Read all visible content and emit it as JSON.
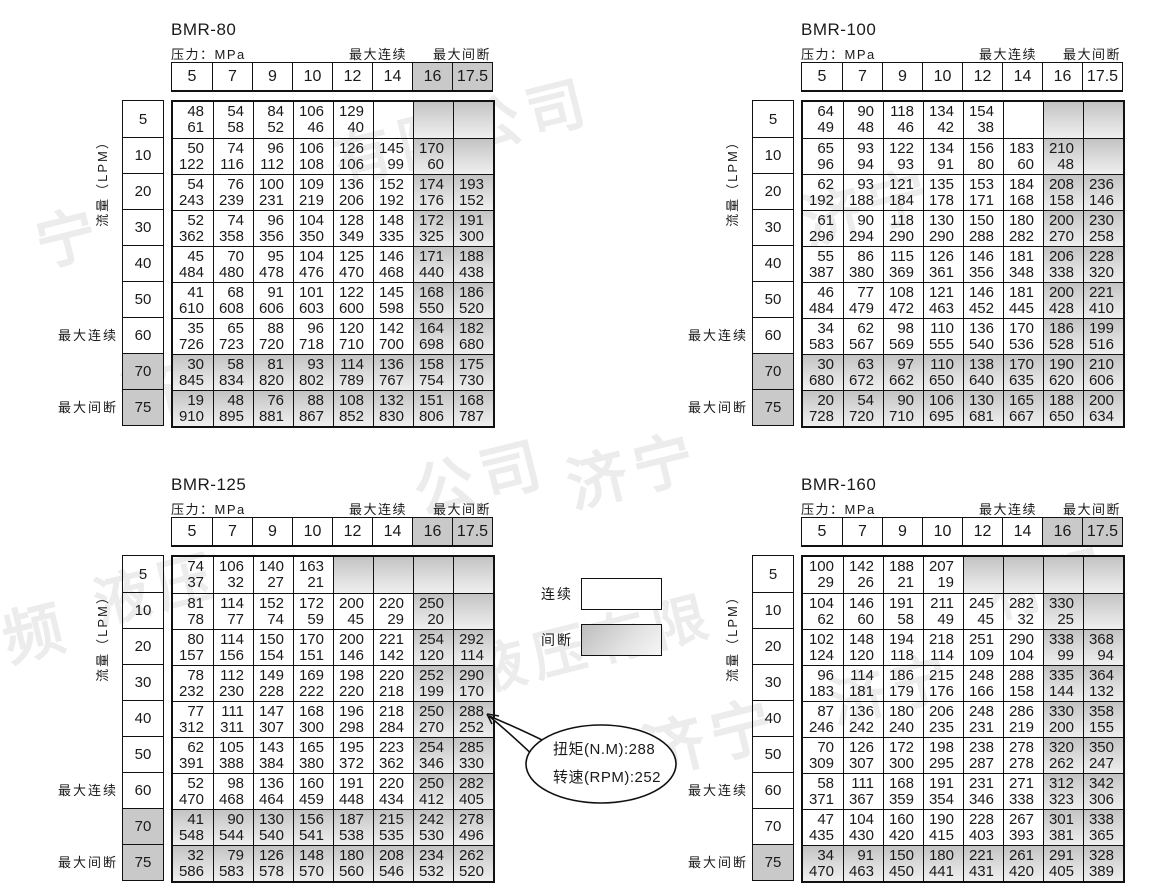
{
  "shared_labels": {
    "pressure": "压力：MPa",
    "max_continuous": "最大连续",
    "max_intermittent": "最大间断",
    "flow": "流量（LPM）"
  },
  "pressures": [
    "5",
    "7",
    "9",
    "10",
    "12",
    "14",
    "16",
    "17.5"
  ],
  "flows": [
    "5",
    "10",
    "20",
    "30",
    "40",
    "50",
    "60",
    "70",
    "75"
  ],
  "legend": {
    "continuous_label": "连续",
    "intermittent_label": "间断"
  },
  "callout": {
    "torque_line": "扭矩(N.M):288",
    "speed_line": "转速(RPM):252"
  },
  "colors": {
    "shade_solid": "#c9c9c9",
    "shade_gradient_top": "#c3c3c3",
    "border": "#111111",
    "watermark": "#ececec"
  },
  "watermark_fragments": [
    {
      "t": "有限公司",
      "x": 330,
      "y": 85,
      "s": 58
    },
    {
      "t": "济宁",
      "x": 800,
      "y": 160,
      "s": 60
    },
    {
      "t": "宁",
      "x": 35,
      "y": 190,
      "s": 60
    },
    {
      "t": "济",
      "x": 120,
      "y": 345,
      "s": 60
    },
    {
      "t": "公司",
      "x": 412,
      "y": 430,
      "s": 60
    },
    {
      "t": "济宁",
      "x": 565,
      "y": 423,
      "s": 60
    },
    {
      "t": "频",
      "x": 2,
      "y": 585,
      "s": 60
    },
    {
      "t": "液压",
      "x": 92,
      "y": 545,
      "s": 56
    },
    {
      "t": "液压有限",
      "x": 468,
      "y": 600,
      "s": 54
    },
    {
      "t": "济宁",
      "x": 640,
      "y": 688,
      "s": 62
    },
    {
      "t": "有限",
      "x": 985,
      "y": 540,
      "s": 56
    },
    {
      "t": "济宁",
      "x": 828,
      "y": 645,
      "s": 56
    }
  ],
  "tables": [
    {
      "title": "BMR-80",
      "pos": {
        "x": 0,
        "y": 20
      },
      "header_shaded": true,
      "shaded_rows": [
        "70",
        "75"
      ],
      "shaded_flow_labels": [
        "70",
        "75"
      ],
      "extra_shaded_cells": [],
      "cells": [
        [
          [
            48,
            61
          ],
          [
            54,
            58
          ],
          [
            84,
            52
          ],
          [
            106,
            46
          ],
          [
            129,
            40
          ],
          null,
          null,
          null
        ],
        [
          [
            50,
            122
          ],
          [
            74,
            116
          ],
          [
            96,
            112
          ],
          [
            106,
            108
          ],
          [
            126,
            106
          ],
          [
            145,
            99
          ],
          [
            170,
            60
          ],
          null
        ],
        [
          [
            54,
            243
          ],
          [
            76,
            239
          ],
          [
            100,
            231
          ],
          [
            109,
            219
          ],
          [
            136,
            206
          ],
          [
            152,
            192
          ],
          [
            174,
            176
          ],
          [
            193,
            152
          ]
        ],
        [
          [
            52,
            362
          ],
          [
            74,
            358
          ],
          [
            96,
            356
          ],
          [
            104,
            350
          ],
          [
            128,
            349
          ],
          [
            148,
            335
          ],
          [
            172,
            325
          ],
          [
            191,
            300
          ]
        ],
        [
          [
            45,
            484
          ],
          [
            70,
            480
          ],
          [
            95,
            478
          ],
          [
            104,
            476
          ],
          [
            125,
            470
          ],
          [
            146,
            468
          ],
          [
            171,
            440
          ],
          [
            188,
            438
          ]
        ],
        [
          [
            41,
            610
          ],
          [
            68,
            608
          ],
          [
            91,
            606
          ],
          [
            101,
            603
          ],
          [
            122,
            600
          ],
          [
            145,
            598
          ],
          [
            168,
            550
          ],
          [
            186,
            520
          ]
        ],
        [
          [
            35,
            726
          ],
          [
            65,
            723
          ],
          [
            88,
            720
          ],
          [
            96,
            718
          ],
          [
            120,
            710
          ],
          [
            142,
            700
          ],
          [
            164,
            698
          ],
          [
            182,
            680
          ]
        ],
        [
          [
            30,
            845
          ],
          [
            58,
            834
          ],
          [
            81,
            820
          ],
          [
            93,
            802
          ],
          [
            114,
            789
          ],
          [
            136,
            767
          ],
          [
            158,
            754
          ],
          [
            175,
            730
          ]
        ],
        [
          [
            19,
            910
          ],
          [
            48,
            895
          ],
          [
            76,
            881
          ],
          [
            88,
            867
          ],
          [
            108,
            852
          ],
          [
            132,
            830
          ],
          [
            151,
            806
          ],
          [
            168,
            787
          ]
        ]
      ]
    },
    {
      "title": "BMR-100",
      "pos": {
        "x": 630,
        "y": 20
      },
      "header_shaded": false,
      "shaded_rows": [
        "70",
        "75"
      ],
      "shaded_flow_labels": [
        "70",
        "75"
      ],
      "extra_shaded_cells": [],
      "cells": [
        [
          [
            64,
            49
          ],
          [
            90,
            48
          ],
          [
            118,
            46
          ],
          [
            134,
            42
          ],
          [
            154,
            38
          ],
          null,
          null,
          null
        ],
        [
          [
            65,
            96
          ],
          [
            93,
            94
          ],
          [
            122,
            93
          ],
          [
            134,
            91
          ],
          [
            156,
            80
          ],
          [
            183,
            60
          ],
          [
            210,
            48
          ],
          null
        ],
        [
          [
            62,
            192
          ],
          [
            93,
            188
          ],
          [
            121,
            184
          ],
          [
            135,
            178
          ],
          [
            153,
            171
          ],
          [
            184,
            168
          ],
          [
            208,
            158
          ],
          [
            236,
            146
          ]
        ],
        [
          [
            61,
            296
          ],
          [
            90,
            294
          ],
          [
            118,
            290
          ],
          [
            130,
            290
          ],
          [
            150,
            288
          ],
          [
            180,
            282
          ],
          [
            200,
            270
          ],
          [
            230,
            258
          ]
        ],
        [
          [
            55,
            387
          ],
          [
            86,
            380
          ],
          [
            115,
            369
          ],
          [
            126,
            361
          ],
          [
            146,
            356
          ],
          [
            181,
            348
          ],
          [
            206,
            338
          ],
          [
            228,
            320
          ]
        ],
        [
          [
            46,
            484
          ],
          [
            77,
            479
          ],
          [
            108,
            472
          ],
          [
            121,
            463
          ],
          [
            146,
            452
          ],
          [
            181,
            445
          ],
          [
            200,
            428
          ],
          [
            221,
            410
          ]
        ],
        [
          [
            34,
            583
          ],
          [
            62,
            567
          ],
          [
            98,
            569
          ],
          [
            110,
            555
          ],
          [
            136,
            540
          ],
          [
            170,
            536
          ],
          [
            186,
            528
          ],
          [
            199,
            516
          ]
        ],
        [
          [
            30,
            680
          ],
          [
            63,
            672
          ],
          [
            97,
            662
          ],
          [
            110,
            650
          ],
          [
            138,
            640
          ],
          [
            170,
            635
          ],
          [
            190,
            620
          ],
          [
            210,
            606
          ]
        ],
        [
          [
            20,
            728
          ],
          [
            54,
            720
          ],
          [
            90,
            710
          ],
          [
            106,
            695
          ],
          [
            130,
            681
          ],
          [
            165,
            667
          ],
          [
            188,
            650
          ],
          [
            200,
            634
          ]
        ]
      ]
    },
    {
      "title": "BMR-125",
      "pos": {
        "x": 0,
        "y": 475
      },
      "header_shaded": true,
      "shaded_rows": [
        "70",
        "75"
      ],
      "shaded_flow_labels": [
        "70",
        "75"
      ],
      "extra_shaded_cells": [
        [
          0,
          4
        ],
        [
          0,
          5
        ]
      ],
      "cells": [
        [
          [
            74,
            37
          ],
          [
            106,
            32
          ],
          [
            140,
            27
          ],
          [
            163,
            21
          ],
          null,
          null,
          null,
          null
        ],
        [
          [
            81,
            78
          ],
          [
            114,
            77
          ],
          [
            152,
            74
          ],
          [
            172,
            59
          ],
          [
            200,
            45
          ],
          [
            220,
            29
          ],
          [
            250,
            20
          ],
          null
        ],
        [
          [
            80,
            157
          ],
          [
            114,
            156
          ],
          [
            150,
            154
          ],
          [
            170,
            151
          ],
          [
            200,
            146
          ],
          [
            221,
            142
          ],
          [
            254,
            120
          ],
          [
            292,
            114
          ]
        ],
        [
          [
            78,
            232
          ],
          [
            112,
            230
          ],
          [
            149,
            228
          ],
          [
            169,
            222
          ],
          [
            198,
            220
          ],
          [
            220,
            218
          ],
          [
            252,
            199
          ],
          [
            290,
            170
          ]
        ],
        [
          [
            77,
            312
          ],
          [
            111,
            311
          ],
          [
            147,
            307
          ],
          [
            168,
            300
          ],
          [
            196,
            298
          ],
          [
            218,
            284
          ],
          [
            250,
            270
          ],
          [
            288,
            252
          ]
        ],
        [
          [
            62,
            391
          ],
          [
            105,
            388
          ],
          [
            143,
            384
          ],
          [
            165,
            380
          ],
          [
            195,
            372
          ],
          [
            223,
            362
          ],
          [
            254,
            346
          ],
          [
            285,
            330
          ]
        ],
        [
          [
            52,
            470
          ],
          [
            98,
            468
          ],
          [
            136,
            464
          ],
          [
            160,
            459
          ],
          [
            191,
            448
          ],
          [
            220,
            434
          ],
          [
            250,
            412
          ],
          [
            282,
            405
          ]
        ],
        [
          [
            41,
            548
          ],
          [
            90,
            544
          ],
          [
            130,
            540
          ],
          [
            156,
            541
          ],
          [
            187,
            538
          ],
          [
            215,
            535
          ],
          [
            242,
            530
          ],
          [
            278,
            496
          ]
        ],
        [
          [
            32,
            586
          ],
          [
            79,
            583
          ],
          [
            126,
            578
          ],
          [
            148,
            570
          ],
          [
            180,
            560
          ],
          [
            208,
            546
          ],
          [
            234,
            532
          ],
          [
            262,
            520
          ]
        ]
      ]
    },
    {
      "title": "BMR-160",
      "pos": {
        "x": 630,
        "y": 475
      },
      "header_shaded": true,
      "shaded_rows": [
        "75"
      ],
      "shaded_flow_labels": [
        "75"
      ],
      "extra_shaded_cells": [
        [
          0,
          4
        ],
        [
          0,
          5
        ]
      ],
      "cells": [
        [
          [
            100,
            29
          ],
          [
            142,
            26
          ],
          [
            188,
            21
          ],
          [
            207,
            19
          ],
          null,
          null,
          null,
          null
        ],
        [
          [
            104,
            62
          ],
          [
            146,
            60
          ],
          [
            191,
            58
          ],
          [
            211,
            49
          ],
          [
            245,
            45
          ],
          [
            282,
            32
          ],
          [
            330,
            25
          ],
          null
        ],
        [
          [
            102,
            124
          ],
          [
            148,
            120
          ],
          [
            194,
            118
          ],
          [
            218,
            114
          ],
          [
            251,
            109
          ],
          [
            290,
            104
          ],
          [
            338,
            99
          ],
          [
            368,
            94
          ]
        ],
        [
          [
            96,
            183
          ],
          [
            114,
            181
          ],
          [
            186,
            179
          ],
          [
            215,
            176
          ],
          [
            248,
            166
          ],
          [
            288,
            158
          ],
          [
            335,
            144
          ],
          [
            364,
            132
          ]
        ],
        [
          [
            87,
            246
          ],
          [
            136,
            242
          ],
          [
            180,
            240
          ],
          [
            206,
            235
          ],
          [
            248,
            231
          ],
          [
            286,
            219
          ],
          [
            330,
            200
          ],
          [
            358,
            155
          ]
        ],
        [
          [
            70,
            309
          ],
          [
            126,
            307
          ],
          [
            172,
            300
          ],
          [
            198,
            295
          ],
          [
            238,
            287
          ],
          [
            278,
            278
          ],
          [
            320,
            262
          ],
          [
            350,
            247
          ]
        ],
        [
          [
            58,
            371
          ],
          [
            111,
            367
          ],
          [
            168,
            359
          ],
          [
            191,
            354
          ],
          [
            231,
            346
          ],
          [
            271,
            338
          ],
          [
            312,
            323
          ],
          [
            342,
            306
          ]
        ],
        [
          [
            47,
            435
          ],
          [
            104,
            430
          ],
          [
            160,
            420
          ],
          [
            190,
            415
          ],
          [
            228,
            403
          ],
          [
            267,
            393
          ],
          [
            301,
            381
          ],
          [
            338,
            365
          ]
        ],
        [
          [
            34,
            470
          ],
          [
            91,
            463
          ],
          [
            150,
            450
          ],
          [
            180,
            441
          ],
          [
            221,
            431
          ],
          [
            261,
            420
          ],
          [
            291,
            405
          ],
          [
            328,
            389
          ]
        ]
      ]
    }
  ]
}
